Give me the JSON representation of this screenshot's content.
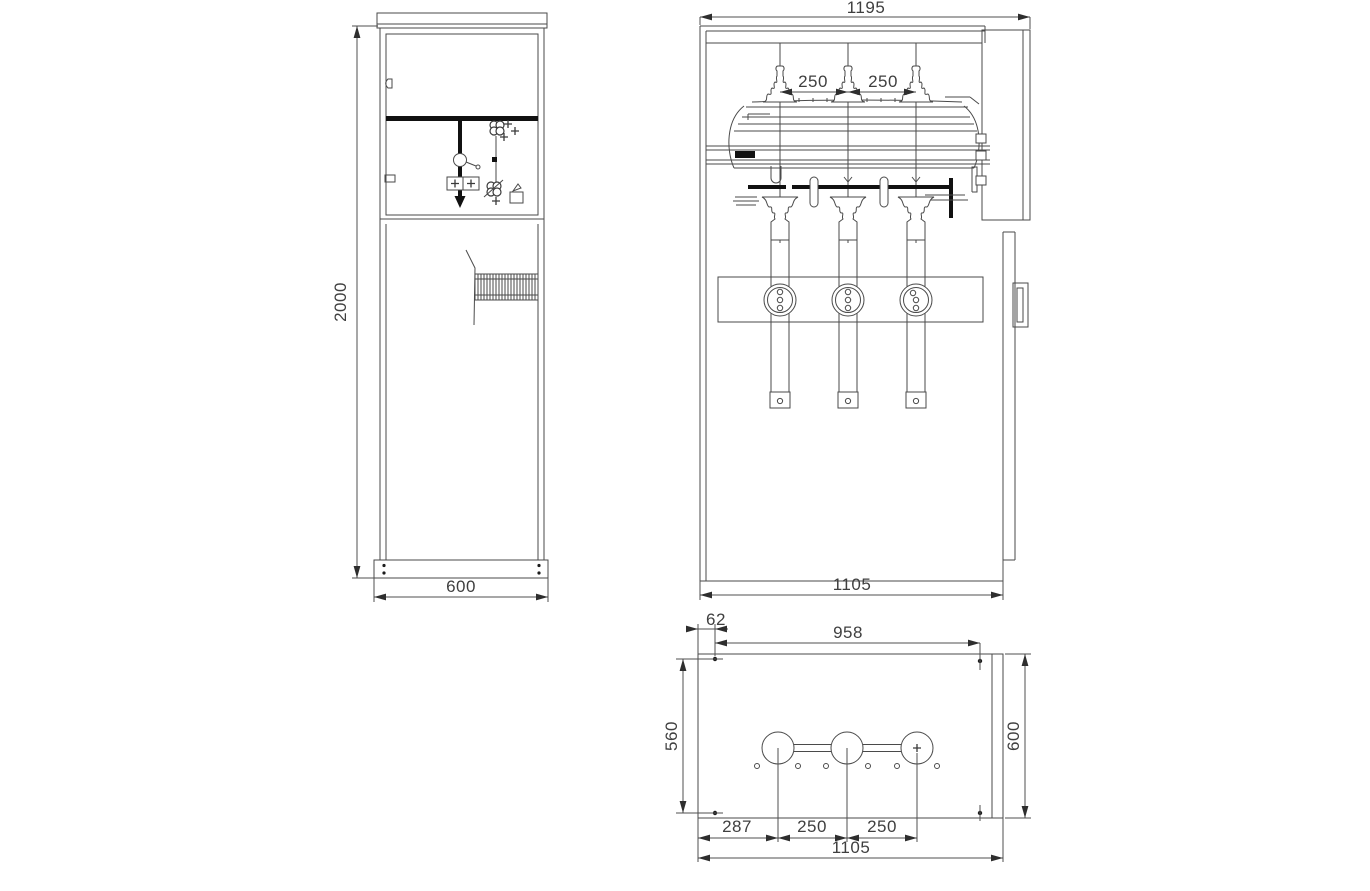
{
  "drawing": {
    "side_view": {
      "height": "2000",
      "width": "600"
    },
    "front_view": {
      "width_top": "1195",
      "pitch_left": "250",
      "pitch_right": "250",
      "width_bottom": "1105"
    },
    "plan_view": {
      "edge_offset": "62",
      "hole_span": "958",
      "hole_rows_span": "560",
      "depth": "600",
      "first_pitch": "287",
      "pitch_left": "250",
      "pitch_right": "250",
      "width": "1105"
    },
    "colors": {
      "line": "#4a4a4a",
      "heavy": "#111111",
      "background": "#ffffff"
    }
  }
}
